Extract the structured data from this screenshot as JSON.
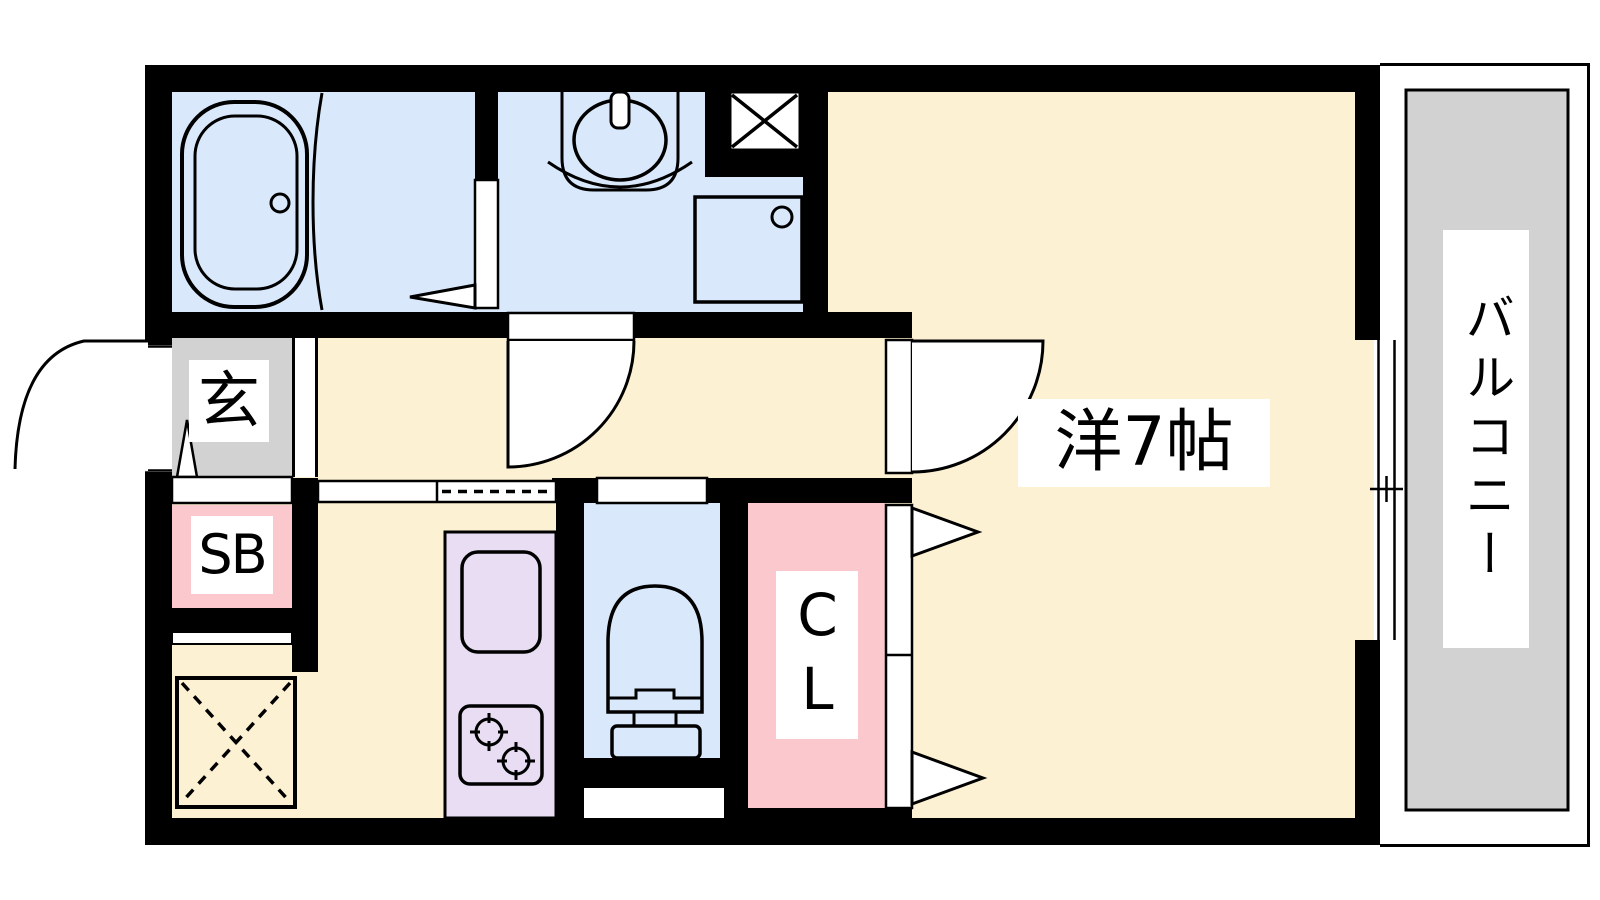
{
  "document": {
    "type": "apartment-floor-plan",
    "style": "japanese-madori"
  },
  "labels": {
    "entrance": "玄",
    "shoe_box": "SB",
    "closet": "CL",
    "main_room": "洋7帖",
    "balcony": "バルコニー"
  },
  "rooms": [
    {
      "name": "bathroom",
      "floor_color": "#D9E9FB",
      "fixtures": [
        "bathtub",
        "folding-door"
      ]
    },
    {
      "name": "washroom",
      "floor_color": "#D9E9FB",
      "fixtures": [
        "washbasin",
        "washing-machine-pan",
        "pipe-space",
        "hinged-door"
      ]
    },
    {
      "name": "toilet",
      "floor_color": "#D9E9FB",
      "fixtures": [
        "toilet"
      ]
    },
    {
      "name": "entrance",
      "label": "玄",
      "floor_color": "#D2D2D2",
      "fixtures": [
        "entrance-door"
      ]
    },
    {
      "name": "shoe-box",
      "label": "SB",
      "floor_color": "#FBC9CD"
    },
    {
      "name": "closet",
      "label": "CL",
      "floor_color": "#FBC9CD",
      "fixtures": [
        "bi-fold-doors"
      ]
    },
    {
      "name": "kitchen",
      "floor_color": "#FCF1D3",
      "fixtures": [
        "kitchen-sink",
        "two-burner-stove",
        "refrigerator-space"
      ]
    },
    {
      "name": "main-room",
      "label": "洋7帖",
      "size_tatami": 7,
      "floor_color": "#FCF1D3",
      "fixtures": [
        "hinged-door",
        "sliding-window"
      ]
    },
    {
      "name": "balcony",
      "label": "バルコニー",
      "floor_color": "#D2D2D2"
    }
  ],
  "colors": {
    "wall": "#000000",
    "room_floor": "#FCF1D3",
    "wet_area_floor": "#D9E9FB",
    "entrance_floor": "#D2D2D2",
    "storage_fill": "#FBC9CD",
    "kitchen_counter": "#E8DDF3",
    "balcony_floor": "#D2D2D2",
    "background": "#FFFFFF"
  }
}
